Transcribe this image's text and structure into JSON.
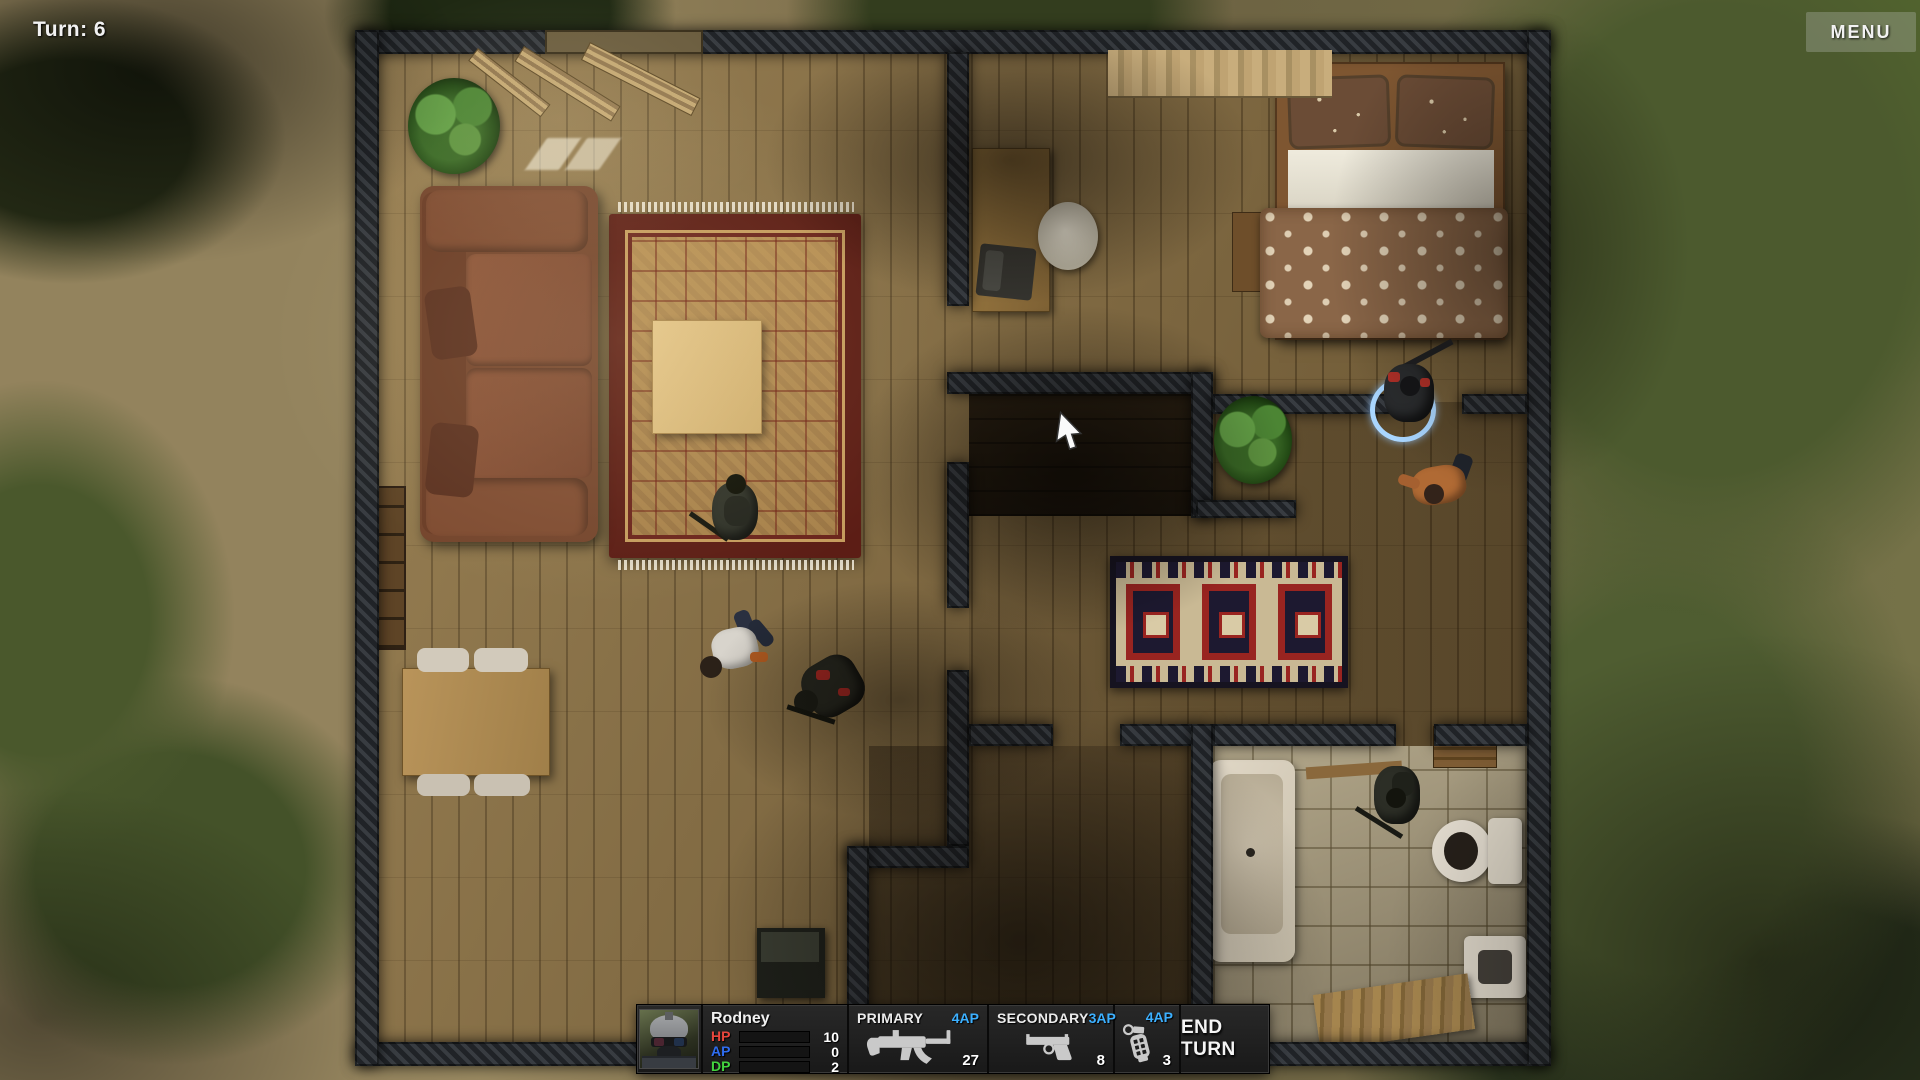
{
  "hud": {
    "turn_label": "Turn: 6",
    "menu_button": "MENU",
    "unit_panel": {
      "portrait_icon": "soldier-portrait",
      "name": "Rodney",
      "stats": [
        {
          "label": "HP",
          "value": "10",
          "color": "#e8463c"
        },
        {
          "label": "AP",
          "value": "0",
          "color": "#2f6df0"
        },
        {
          "label": "DP",
          "value": "2",
          "color": "#43d33f"
        }
      ],
      "primary": {
        "label": "PRIMARY",
        "ap_cost": "4AP",
        "ammo": "27",
        "icon": "smg-icon"
      },
      "secondary": {
        "label": "SECONDARY",
        "ap_cost": "3AP",
        "ammo": "8",
        "icon": "pistol-icon"
      },
      "throwable": {
        "ap_cost": "4AP",
        "count": "3",
        "icon": "grenade-icon"
      },
      "end_turn_button": "END TURN"
    },
    "colors": {
      "ap_cost_text": "#3cb0ff",
      "hp_bar": "#e0413a",
      "ap_bar": "#6f6f6f",
      "dp_bar": "#55d84f",
      "panel_bg": "#1e1e1e",
      "selection_ring": "#a9d6ff"
    }
  },
  "scene": {
    "cursor": "arrow-cursor",
    "units": [
      {
        "id": "soldier-living-room",
        "type": "soldier"
      },
      {
        "id": "civilian-fallen",
        "type": "civilian"
      },
      {
        "id": "soldier-fallen",
        "type": "soldier"
      },
      {
        "id": "soldier-selected",
        "type": "soldier",
        "selected": true
      },
      {
        "id": "civilian-fallen-2",
        "type": "civilian"
      },
      {
        "id": "soldier-bathroom",
        "type": "soldier"
      }
    ]
  }
}
